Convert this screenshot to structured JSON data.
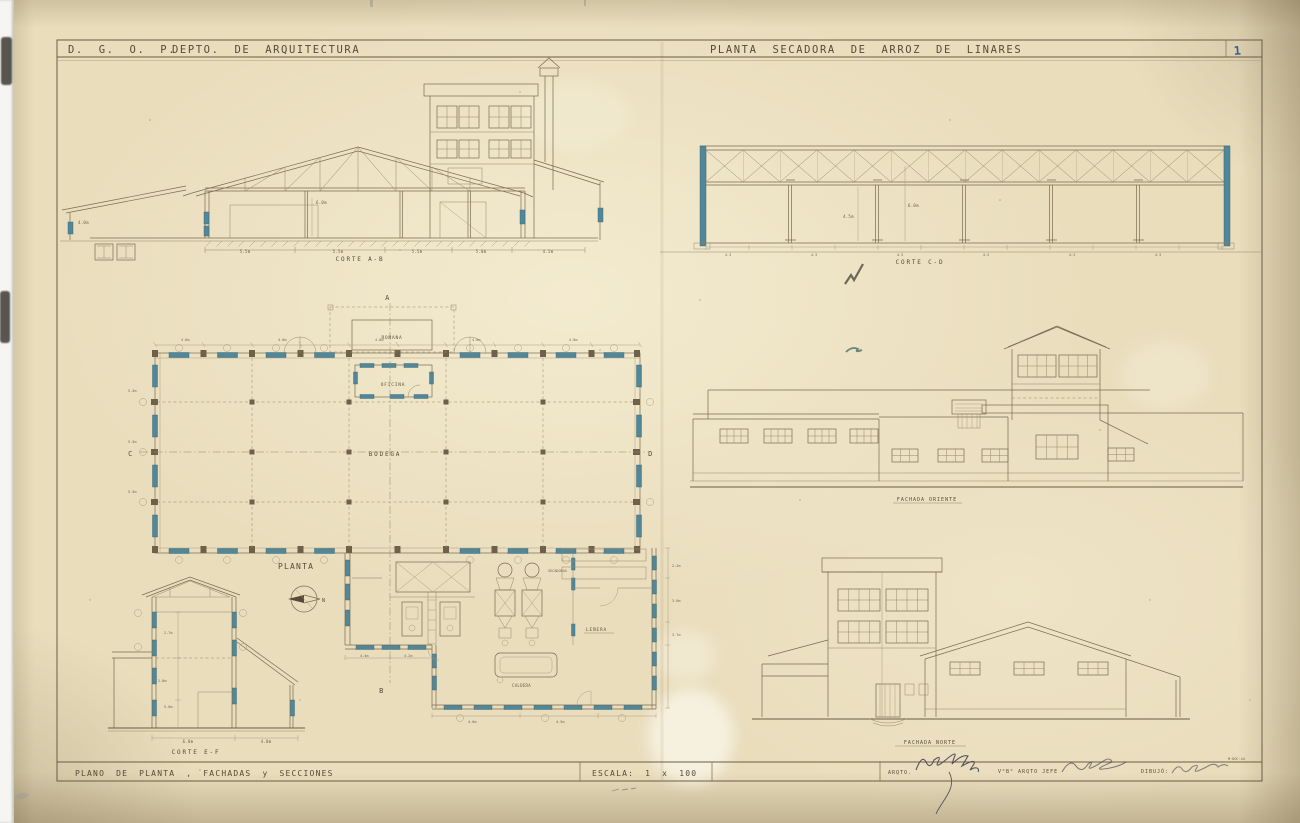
{
  "header": {
    "org": "D. G. O. P.",
    "dept": "DEPTO. DE ARQUITECTURA",
    "title": "PLANTA SECADORA DE ARROZ DE LINARES",
    "sheet_no": "1"
  },
  "footer": {
    "title": "PLANO DE PLANTA , FACHADAS y SECCIONES",
    "scale": "ESCALA: 1 x 100",
    "arqto": "ARQTO.",
    "vobo": "V°B° ARQTO JEFE",
    "dibujo": "DIBUJÓ:",
    "date_code": "M·DGC·44"
  },
  "labels": {
    "corte_ab": "CORTE A-B",
    "corte_cd": "CORTE C-D",
    "corte_ef": "CORTE E-F",
    "planta": "PLANTA",
    "fachada_oriente": "FACHADA ORIENTE",
    "fachada_norte": "FACHADA NORTE"
  },
  "rooms": {
    "romana": "ROMANA",
    "oficina": "OFICINA",
    "bodega": "BODEGA",
    "lenera": "LEÑERA",
    "secadoras": "SECADORAS",
    "caldera": "CALDERA"
  },
  "axes": {
    "a": "A",
    "b": "B",
    "c": "C",
    "d": "D",
    "north": "N"
  },
  "dims": {
    "ab": [
      "5.5m",
      "5.5m",
      "5.5m",
      "5.0m",
      "4.5m"
    ],
    "ab_h": [
      "6.0m",
      "4.0m"
    ],
    "cd": [
      "4.3",
      "4.3",
      "4.3",
      "4.3",
      "4.3",
      "4.3"
    ],
    "cd_h": [
      "4.5m",
      "6.0m"
    ],
    "plan_top": [
      "4.8m",
      "4.8m",
      "4.8m",
      "4.8m",
      "4.8m"
    ],
    "plan_left": [
      "5.5m",
      "5.5m",
      "5.5m"
    ],
    "ef": [
      "6.0m",
      "4.0m"
    ],
    "ef_h": [
      "2.7m",
      "2.8m",
      "5.0m"
    ],
    "annex_right": [
      "2.2m",
      "3.0m",
      "3.7m"
    ],
    "annex_bottom": [
      "4.4m",
      "4.2m",
      "4.0m",
      "4.5m"
    ]
  }
}
